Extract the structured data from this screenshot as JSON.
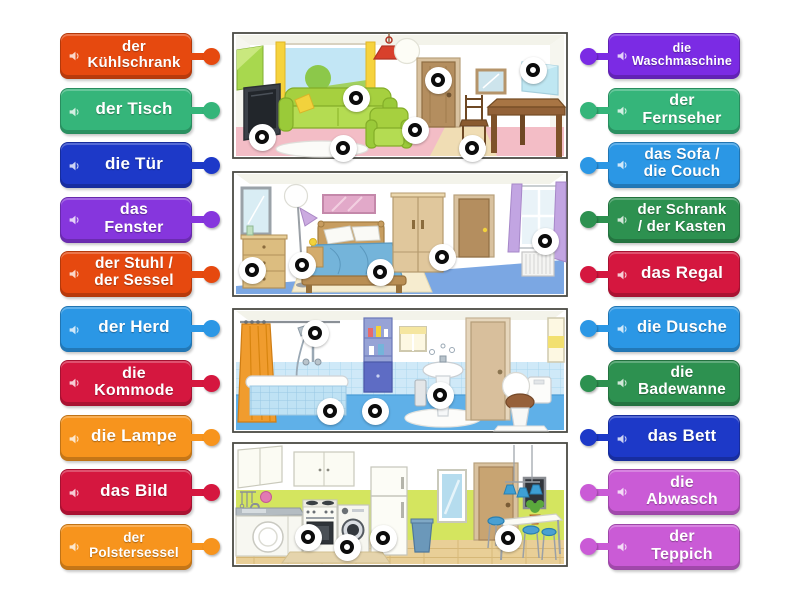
{
  "page": {
    "background": "#ffffff"
  },
  "icons": {
    "label_audio": "speaker",
    "marker": "bullseye-circle"
  },
  "labels": {
    "left": [
      {
        "id": "kuehlschrank",
        "text": "der\nKühlschrank",
        "color": "#e6490f",
        "font_px": 15
      },
      {
        "id": "tisch",
        "text": "der Tisch",
        "color": "#35b57a",
        "font_px": 17
      },
      {
        "id": "tuer",
        "text": "die Tür",
        "color": "#1d39c8",
        "font_px": 17
      },
      {
        "id": "fenster",
        "text": "das\nFenster",
        "color": "#8636dd",
        "font_px": 16
      },
      {
        "id": "stuhl-sessel",
        "text": "der Stuhl /\nder Sessel",
        "color": "#e6490f",
        "font_px": 15.5
      },
      {
        "id": "herd",
        "text": "der Herd",
        "color": "#2b97e5",
        "font_px": 17
      },
      {
        "id": "kommode",
        "text": "die\nKommode",
        "color": "#d5173f",
        "font_px": 16
      },
      {
        "id": "lampe",
        "text": "die Lampe",
        "color": "#f7941d",
        "font_px": 17
      },
      {
        "id": "bild",
        "text": "das Bild",
        "color": "#d5173f",
        "font_px": 17
      },
      {
        "id": "polstersessel",
        "text": "der\nPolstersessel",
        "color": "#f7941d",
        "font_px": 13.5
      }
    ],
    "right": [
      {
        "id": "waschmaschine",
        "text": "die\nWaschmaschine",
        "color": "#7b2be4",
        "font_px": 12.5
      },
      {
        "id": "fernseher",
        "text": "der\nFernseher",
        "color": "#35b57a",
        "font_px": 16
      },
      {
        "id": "sofa-couch",
        "text": "das Sofa /\ndie Couch",
        "color": "#2b97e5",
        "font_px": 15.5
      },
      {
        "id": "schrank-kasten",
        "text": "der Schrank\n/ der Kasten",
        "color": "#2d9150",
        "font_px": 15
      },
      {
        "id": "regal",
        "text": "das Regal",
        "color": "#d5173f",
        "font_px": 17
      },
      {
        "id": "dusche",
        "text": "die Dusche",
        "color": "#2b97e5",
        "font_px": 16.5
      },
      {
        "id": "badewanne",
        "text": "die\nBadewanne",
        "color": "#2d9150",
        "font_px": 15.5
      },
      {
        "id": "bett",
        "text": "das Bett",
        "color": "#1d39c8",
        "font_px": 17
      },
      {
        "id": "abwasch",
        "text": "die\nAbwasch",
        "color": "#ca5bd6",
        "font_px": 16
      },
      {
        "id": "teppich",
        "text": "der\nTeppich",
        "color": "#ca5bd6",
        "font_px": 16
      }
    ]
  },
  "diagram": {
    "rooms": [
      "living-room",
      "bedroom",
      "bathroom",
      "kitchen"
    ],
    "marker_style": {
      "disc_px": 27,
      "ring_color": "#0c0c0c",
      "disc_color": "#ffffff"
    },
    "markers": [
      {
        "id": "tv",
        "room": "living-room",
        "x": 262,
        "y": 137
      },
      {
        "id": "sofa",
        "room": "living-room",
        "x": 356,
        "y": 98
      },
      {
        "id": "rug",
        "room": "living-room",
        "x": 343,
        "y": 148
      },
      {
        "id": "armchair",
        "room": "living-room",
        "x": 415,
        "y": 130
      },
      {
        "id": "door",
        "room": "living-room",
        "x": 438,
        "y": 80
      },
      {
        "id": "picture",
        "room": "living-room",
        "x": 533,
        "y": 70
      },
      {
        "id": "chair",
        "room": "living-room",
        "x": 472,
        "y": 148
      },
      {
        "id": "dresser",
        "room": "bedroom",
        "x": 252,
        "y": 270
      },
      {
        "id": "floor-lamp",
        "room": "bedroom",
        "x": 302,
        "y": 265
      },
      {
        "id": "bed",
        "room": "bedroom",
        "x": 380,
        "y": 272
      },
      {
        "id": "wardrobe",
        "room": "bedroom",
        "x": 442,
        "y": 257
      },
      {
        "id": "window",
        "room": "bedroom",
        "x": 545,
        "y": 241
      },
      {
        "id": "shower",
        "room": "bathroom",
        "x": 315,
        "y": 333
      },
      {
        "id": "bathtub",
        "room": "bathroom",
        "x": 330,
        "y": 411
      },
      {
        "id": "shelf",
        "room": "bathroom",
        "x": 375,
        "y": 411
      },
      {
        "id": "sink",
        "room": "bathroom",
        "x": 440,
        "y": 395
      },
      {
        "id": "stove",
        "room": "kitchen",
        "x": 308,
        "y": 537
      },
      {
        "id": "washing-machine",
        "room": "kitchen",
        "x": 347,
        "y": 547
      },
      {
        "id": "fridge",
        "room": "kitchen",
        "x": 383,
        "y": 538
      },
      {
        "id": "table",
        "room": "kitchen",
        "x": 508,
        "y": 538
      }
    ]
  }
}
